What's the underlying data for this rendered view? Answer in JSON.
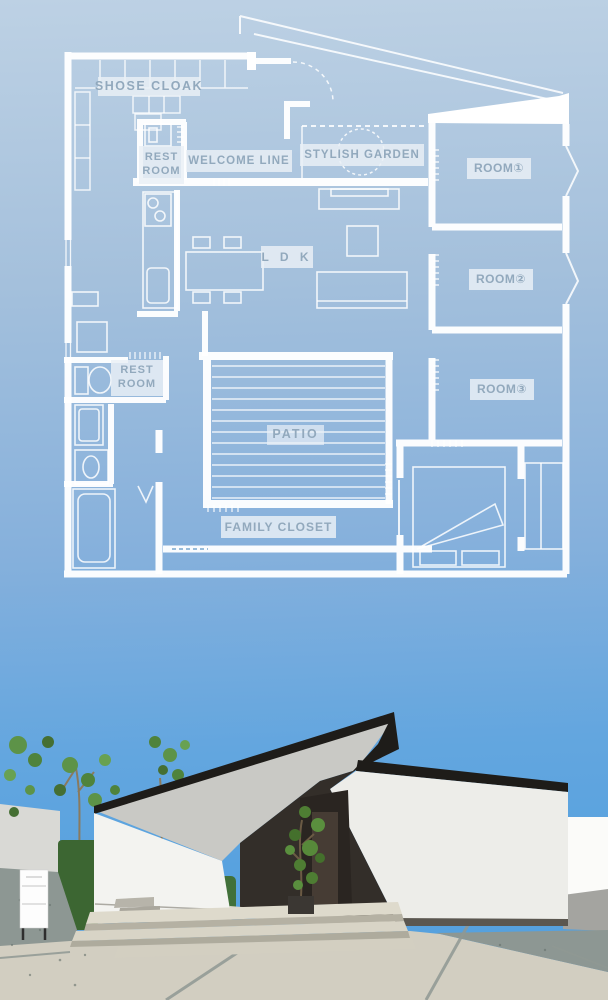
{
  "meta": {
    "width": 608,
    "height": 1000,
    "description_visible_text_only": true
  },
  "floor_plan": {
    "labels": {
      "shose_cloak": "SHOSE CLOAK",
      "rest_room_upper": {
        "line1": "REST",
        "line2": "ROOM"
      },
      "welcome_line": "WELCOME LINE",
      "stylish_garden": "STYLISH GARDEN",
      "room_1": "ROOM①",
      "room_2": "ROOM②",
      "room_3": "ROOM③",
      "ldk": "L D K",
      "rest_room_lower": {
        "line1": "REST",
        "line2": "ROOM"
      },
      "patio": "PATIO",
      "family_closet": "FAMILY CLOSET"
    },
    "style": {
      "line_color": "#ffffff",
      "label_bg": "rgba(233,239,246,0.84)",
      "label_text": "#92a9bd"
    }
  },
  "background": {
    "gradient_top": "#bdd1e4",
    "gradient_bottom": "#55a0dc"
  },
  "exterior_render": {
    "sky": "#57a2df",
    "wall_white": "#f3f3f0",
    "roof_black": "#1e1c19",
    "entrance_dark": "#332e29",
    "pavement": "#d2cec1",
    "gravel": "#8d9793",
    "greenery": "#55893e"
  }
}
